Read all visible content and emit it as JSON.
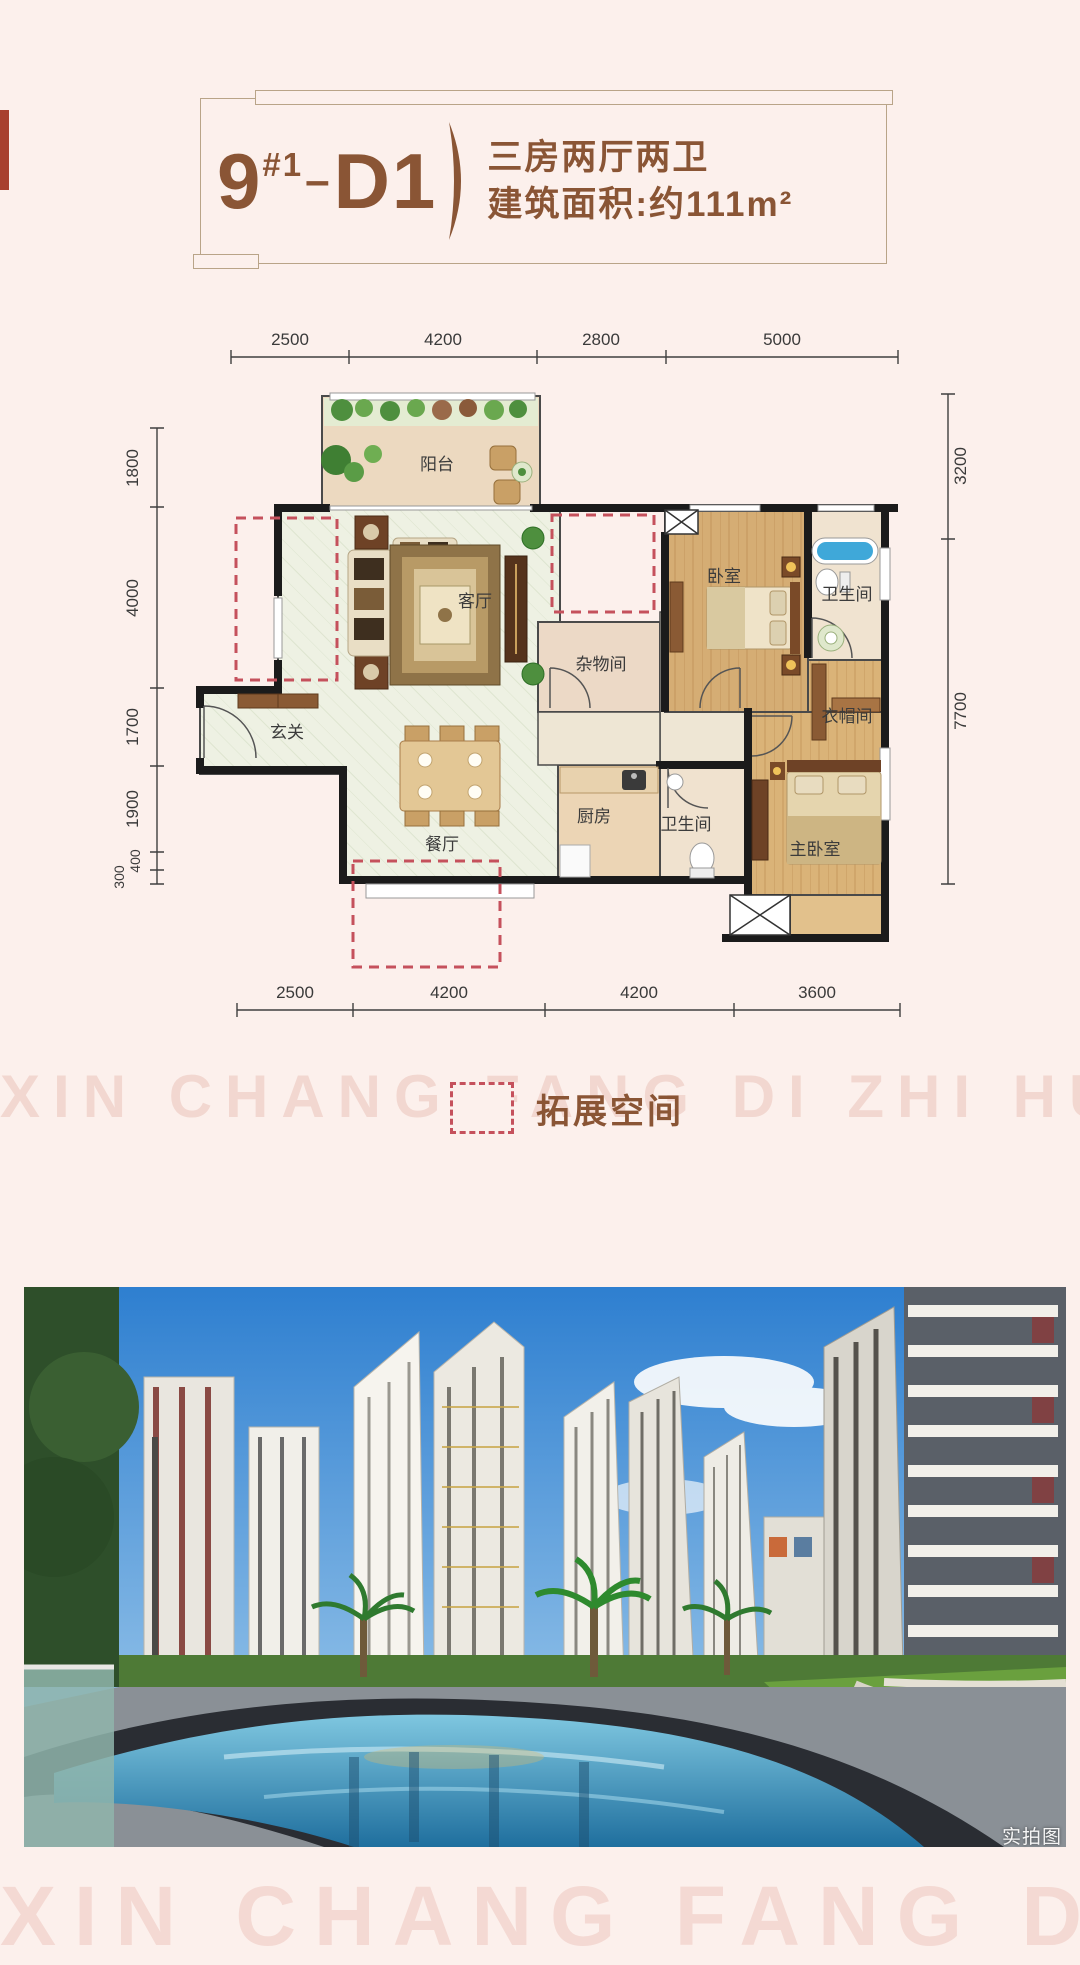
{
  "page": {
    "background": "#fcf0ec"
  },
  "colors": {
    "brand_brown": "#8a5535",
    "frame_tan": "#b9a488",
    "dim_gray": "#3a3a3a",
    "expansion_red": "#c5515c",
    "left_bar_red": "#a8402e",
    "wall_black": "#1b1b1b",
    "watermark_pink": "#f2d7d0"
  },
  "title": {
    "block": "9",
    "block_sup": "#1",
    "separator": "–",
    "unit": "D1",
    "layout_line1": "三房两厅两卫",
    "layout_line2": "建筑面积:约111m²"
  },
  "floorplan": {
    "rooms": [
      {
        "name": "阳台"
      },
      {
        "name": "客厅"
      },
      {
        "name": "玄关"
      },
      {
        "name": "餐厅"
      },
      {
        "name": "厨房"
      },
      {
        "name": "卫生间"
      },
      {
        "name": "杂物间"
      },
      {
        "name": "卧室"
      },
      {
        "name": "卫生间"
      },
      {
        "name": "衣帽间"
      },
      {
        "name": "主卧室"
      }
    ],
    "dims_top": [
      "2500",
      "4200",
      "2800",
      "5000"
    ],
    "dims_bottom": [
      "2500",
      "4200",
      "4200",
      "3600"
    ],
    "dims_left": [
      "1800",
      "4000",
      "1700",
      "1900",
      "400",
      "300"
    ],
    "dims_right": [
      "3200",
      "7700"
    ]
  },
  "legend": {
    "label": "拓展空间"
  },
  "watermark": {
    "row1": "XIN CHANG FANG DI ZHI HUA",
    "row2": "XIN CHANG FANG DI ZHI HUA"
  },
  "photo": {
    "caption": "实拍图"
  }
}
